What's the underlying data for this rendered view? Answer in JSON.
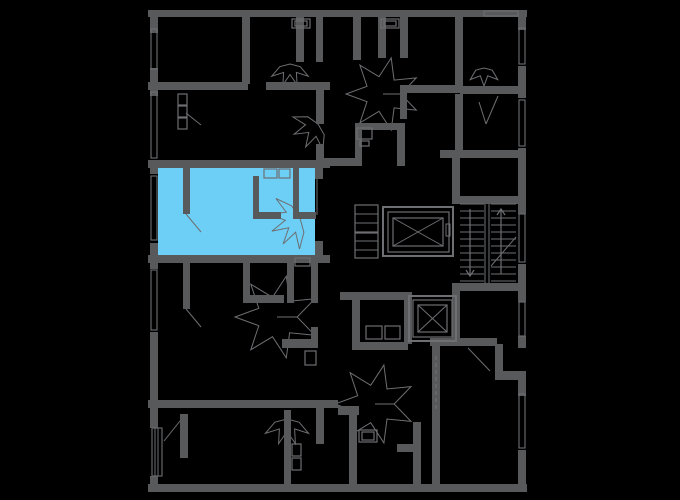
{
  "meta": {
    "description": "Apartment building floor plan with one selected unit highlighted",
    "canvas_width": 680,
    "canvas_height": 500
  },
  "colors": {
    "background": "#000000",
    "wall": "#58595B",
    "line": "#6E6F72",
    "highlight": "#6DCFF6"
  },
  "selected_apartment": {
    "rect": [
      158,
      167,
      157,
      89
    ]
  },
  "walls": [
    [
      148,
      10,
      379,
      7
    ],
    [
      148,
      484,
      379,
      8
    ],
    [
      150,
      10,
      8,
      23
    ],
    [
      150,
      68,
      8,
      28
    ],
    [
      150,
      160,
      8,
      14
    ],
    [
      150,
      243,
      8,
      26
    ],
    [
      150,
      332,
      8,
      96
    ],
    [
      150,
      476,
      8,
      12
    ],
    [
      518,
      10,
      8,
      20
    ],
    [
      518,
      66,
      8,
      32
    ],
    [
      518,
      148,
      8,
      66
    ],
    [
      518,
      264,
      8,
      38
    ],
    [
      518,
      336,
      8,
      12
    ],
    [
      495,
      344,
      8,
      31
    ],
    [
      495,
      371,
      31,
      9
    ],
    [
      518,
      377,
      8,
      19
    ],
    [
      518,
      450,
      8,
      36
    ],
    [
      242,
      10,
      8,
      74
    ],
    [
      148,
      82,
      100,
      8
    ],
    [
      266,
      82,
      64,
      8
    ],
    [
      296,
      10,
      8,
      52
    ],
    [
      316,
      10,
      7,
      52
    ],
    [
      316,
      86,
      8,
      38
    ],
    [
      316,
      144,
      8,
      24
    ],
    [
      148,
      160,
      182,
      8
    ],
    [
      148,
      255,
      182,
      8
    ],
    [
      183,
      166,
      7,
      48
    ],
    [
      253,
      176,
      6,
      43
    ],
    [
      293,
      168,
      6,
      51
    ],
    [
      253,
      212,
      28,
      7
    ],
    [
      298,
      212,
      18,
      7
    ],
    [
      315,
      160,
      8,
      19
    ],
    [
      315,
      241,
      8,
      22
    ],
    [
      183,
      261,
      7,
      48
    ],
    [
      243,
      261,
      7,
      42
    ],
    [
      243,
      295,
      41,
      8
    ],
    [
      287,
      255,
      7,
      48
    ],
    [
      311,
      255,
      7,
      48
    ],
    [
      311,
      327,
      7,
      20
    ],
    [
      282,
      339,
      36,
      9
    ],
    [
      148,
      400,
      190,
      8
    ],
    [
      338,
      406,
      21,
      9
    ],
    [
      316,
      406,
      8,
      38
    ],
    [
      400,
      85,
      60,
      8
    ],
    [
      400,
      93,
      7,
      26
    ],
    [
      355,
      123,
      45,
      7
    ],
    [
      355,
      130,
      7,
      36
    ],
    [
      397,
      123,
      8,
      43
    ],
    [
      353,
      10,
      8,
      50
    ],
    [
      378,
      10,
      8,
      48
    ],
    [
      400,
      10,
      8,
      48
    ],
    [
      316,
      158,
      42,
      8
    ],
    [
      455,
      10,
      8,
      80
    ],
    [
      460,
      86,
      66,
      8
    ],
    [
      455,
      94,
      8,
      62
    ],
    [
      440,
      150,
      86,
      8
    ],
    [
      452,
      158,
      8,
      42
    ],
    [
      452,
      196,
      74,
      8
    ],
    [
      452,
      283,
      74,
      8
    ],
    [
      452,
      291,
      8,
      53
    ],
    [
      340,
      292,
      68,
      8
    ],
    [
      352,
      300,
      8,
      44
    ],
    [
      352,
      342,
      56,
      8
    ],
    [
      404,
      292,
      8,
      52
    ],
    [
      430,
      338,
      67,
      8
    ],
    [
      432,
      346,
      8,
      138
    ],
    [
      284,
      410,
      7,
      74
    ],
    [
      349,
      413,
      8,
      71
    ],
    [
      180,
      414,
      8,
      44
    ],
    [
      413,
      422,
      8,
      62
    ],
    [
      397,
      444,
      20,
      8
    ]
  ],
  "windows": [
    [
      151,
      29,
      6,
      40
    ],
    [
      151,
      92,
      6,
      66
    ],
    [
      151,
      176,
      6,
      64
    ],
    [
      151,
      270,
      6,
      60
    ],
    [
      519,
      28,
      6,
      36
    ],
    [
      519,
      100,
      6,
      46
    ],
    [
      519,
      214,
      6,
      48
    ],
    [
      519,
      302,
      6,
      34
    ],
    [
      519,
      394,
      6,
      54
    ],
    [
      484,
      11,
      34,
      5
    ]
  ],
  "balcony_rail": {
    "rect": [
      152,
      428,
      10,
      48
    ],
    "lines": [
      [
        155,
        428,
        155,
        476
      ],
      [
        158,
        428,
        158,
        476
      ]
    ]
  },
  "fixtures": [
    [
      292,
      19,
      18,
      9
    ],
    [
      295,
      21,
      12,
      5
    ],
    [
      381,
      19,
      18,
      9
    ],
    [
      384,
      21,
      12,
      5
    ],
    [
      264,
      169,
      13,
      9
    ],
    [
      279,
      169,
      11,
      9
    ],
    [
      295,
      258,
      15,
      8
    ],
    [
      357,
      128,
      15,
      11
    ],
    [
      360,
      141,
      9,
      5
    ],
    [
      355,
      205,
      23,
      27
    ],
    [
      355,
      233,
      23,
      25
    ],
    [
      366,
      326,
      16,
      13
    ],
    [
      385,
      326,
      15,
      13
    ],
    [
      292,
      444,
      9,
      12
    ],
    [
      292,
      458,
      9,
      12
    ],
    [
      359,
      430,
      18,
      12
    ],
    [
      362,
      432,
      12,
      8
    ],
    [
      305,
      351,
      11,
      14
    ],
    [
      178,
      94,
      9,
      11
    ],
    [
      178,
      106,
      9,
      11
    ],
    [
      178,
      118,
      9,
      11
    ]
  ],
  "fixture_lines": [
    [
      355,
      214,
      378,
      214
    ],
    [
      355,
      223,
      378,
      223
    ],
    [
      355,
      241,
      378,
      241
    ],
    [
      355,
      250,
      378,
      250
    ]
  ],
  "elevators": [
    {
      "outer": [
        383,
        207,
        70,
        49
      ],
      "mid": [
        388,
        212,
        61,
        40
      ],
      "inner": [
        393,
        218,
        50,
        28
      ],
      "tick": [
        446,
        224,
        4,
        12
      ]
    },
    {
      "outer": [
        409,
        296,
        47,
        45
      ],
      "mid": [
        413,
        300,
        39,
        37
      ],
      "inner": [
        418,
        305,
        29,
        27
      ]
    }
  ],
  "stairs": {
    "flights": [
      [
        460,
        484
      ],
      [
        491,
        516
      ]
    ],
    "tread_ys": [
      204,
      211,
      218,
      225,
      232,
      239,
      246,
      253,
      260,
      267,
      274,
      281
    ],
    "stringers": [
      [
        485,
        204,
        485,
        283
      ],
      [
        489,
        204,
        489,
        283
      ]
    ],
    "diagonal": [
      491,
      266,
      516,
      237
    ]
  },
  "arrows": [
    {
      "x": 501,
      "y1": 274,
      "y2": 209,
      "dir": "up"
    },
    {
      "x": 470,
      "y1": 209,
      "y2": 276,
      "dir": "down"
    }
  ],
  "fans": [
    {
      "cx": 383,
      "cy": 94,
      "r": 37,
      "a0": 0,
      "a1": 360,
      "leaves": 7
    },
    {
      "cx": 290,
      "cy": 64,
      "r": 22,
      "a0": 15,
      "a1": 165,
      "leaves": 4
    },
    {
      "cx": 484,
      "cy": 68,
      "r": 18,
      "a0": 15,
      "a1": 165,
      "leaves": 3
    },
    {
      "cx": 318,
      "cy": 124,
      "r": 26,
      "a0": 60,
      "a1": 215,
      "leaves": 4
    },
    {
      "cx": 300,
      "cy": 218,
      "r": 31,
      "a0": 75,
      "a1": 235,
      "leaves": 5
    },
    {
      "cx": 277,
      "cy": 317,
      "r": 42,
      "a0": 0,
      "a1": 360,
      "leaves": 7
    },
    {
      "cx": 375,
      "cy": 404,
      "r": 40,
      "a0": 0,
      "a1": 360,
      "leaves": 7
    },
    {
      "cx": 287,
      "cy": 419,
      "r": 26,
      "a0": 15,
      "a1": 165,
      "leaves": 4
    }
  ],
  "door_leaves": [
    [
      186,
      214,
      201,
      232
    ],
    [
      186,
      309,
      201,
      327
    ],
    [
      184,
      416,
      164,
      441
    ],
    [
      186,
      113,
      201,
      125
    ],
    [
      498,
      96,
      486,
      124
    ],
    [
      486,
      124,
      479,
      102
    ],
    [
      468,
      348,
      490,
      371
    ],
    [
      317,
      179,
      317,
      215
    ]
  ],
  "dashed_lines": [
    [
      436,
      356,
      436,
      412
    ]
  ]
}
